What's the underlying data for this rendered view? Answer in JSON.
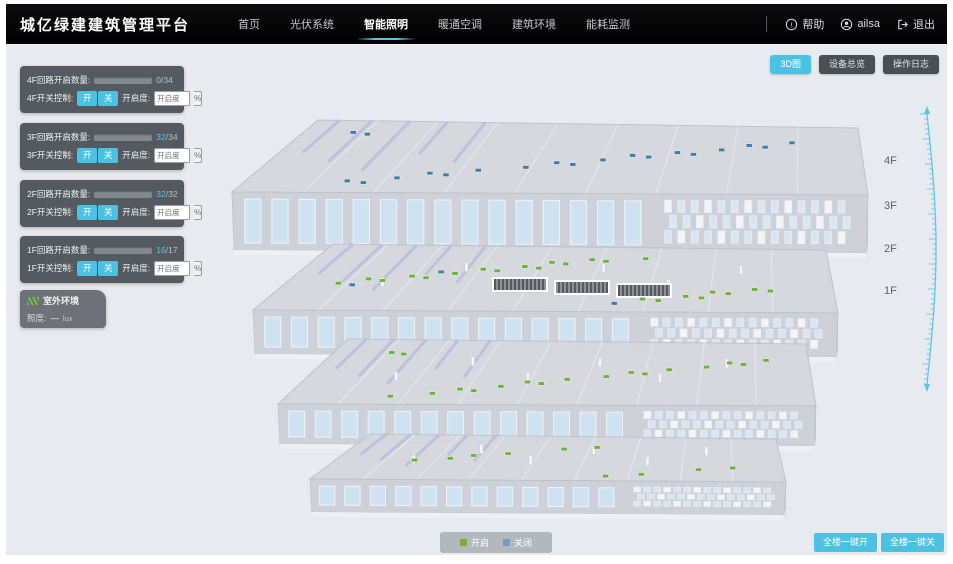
{
  "header": {
    "title": "城亿绿建建筑管理平台",
    "nav": {
      "home": "首页",
      "pv": "光伏系统",
      "lighting": "智能照明",
      "hvac": "暖通空调",
      "env": "建筑环境",
      "energy": "能耗监测"
    },
    "help": "帮助",
    "username": "ailsa",
    "logout": "退出"
  },
  "toolbar": {
    "view_3d": "3D图",
    "device_overview": "设备总览",
    "operation_log": "操作日志"
  },
  "floors": [
    {
      "id": "4F",
      "circuit_label": "4F回路开启数量:",
      "on_text": "0",
      "total_text": "/34",
      "bar_style": "width:0%",
      "num_style": "color:#b9bec4",
      "switch_label": "4F开关控制:",
      "btn_on": "开",
      "btn_off": "关",
      "dim_label": "开启度:",
      "dim_placeholder": "开启度",
      "percent_label": "%"
    },
    {
      "id": "3F",
      "circuit_label": "3F回路开启数量:",
      "on_text": "32",
      "total_text": "/34",
      "bar_style": "width:94%",
      "num_style": "color:#4fc8e8",
      "switch_label": "3F开关控制:",
      "btn_on": "开",
      "btn_off": "关",
      "dim_label": "开启度:",
      "dim_placeholder": "开启度",
      "percent_label": "%"
    },
    {
      "id": "2F",
      "circuit_label": "2F回路开启数量:",
      "on_text": "32",
      "total_text": "/32",
      "bar_style": "width:100%",
      "num_style": "color:#4fc8e8",
      "switch_label": "2F开关控制:",
      "btn_on": "开",
      "btn_off": "关",
      "dim_label": "开启度:",
      "dim_placeholder": "开启度",
      "percent_label": "%"
    },
    {
      "id": "1F",
      "circuit_label": "1F回路开启数量:",
      "on_text": "16",
      "total_text": "/17",
      "bar_style": "width:94%",
      "num_style": "color:#4fc8e8",
      "switch_label": "1F开关控制:",
      "btn_on": "开",
      "btn_off": "关",
      "dim_label": "开启度:",
      "dim_placeholder": "开启度",
      "percent_label": "%"
    }
  ],
  "outdoor": {
    "title": "室外环境",
    "metric_label": "照度:",
    "metric_value": "—",
    "metric_unit": "lux"
  },
  "floor_labels": {
    "f4": "4F",
    "f3": "3F",
    "f2": "2F",
    "f1": "1F"
  },
  "legend": {
    "on_label": "开启",
    "off_label": "关闭",
    "on_style": "background:#76b041",
    "off_style": "background:#6f9cc9"
  },
  "bulk": {
    "all_on": "全楼一键开",
    "all_off": "全楼一键关"
  },
  "colors": {
    "accent_cyan": "#4cc2e2",
    "light_on_green": "#69b33c",
    "light_off_blue": "#3e7da5",
    "nav_underline": "#4ec7ea"
  }
}
